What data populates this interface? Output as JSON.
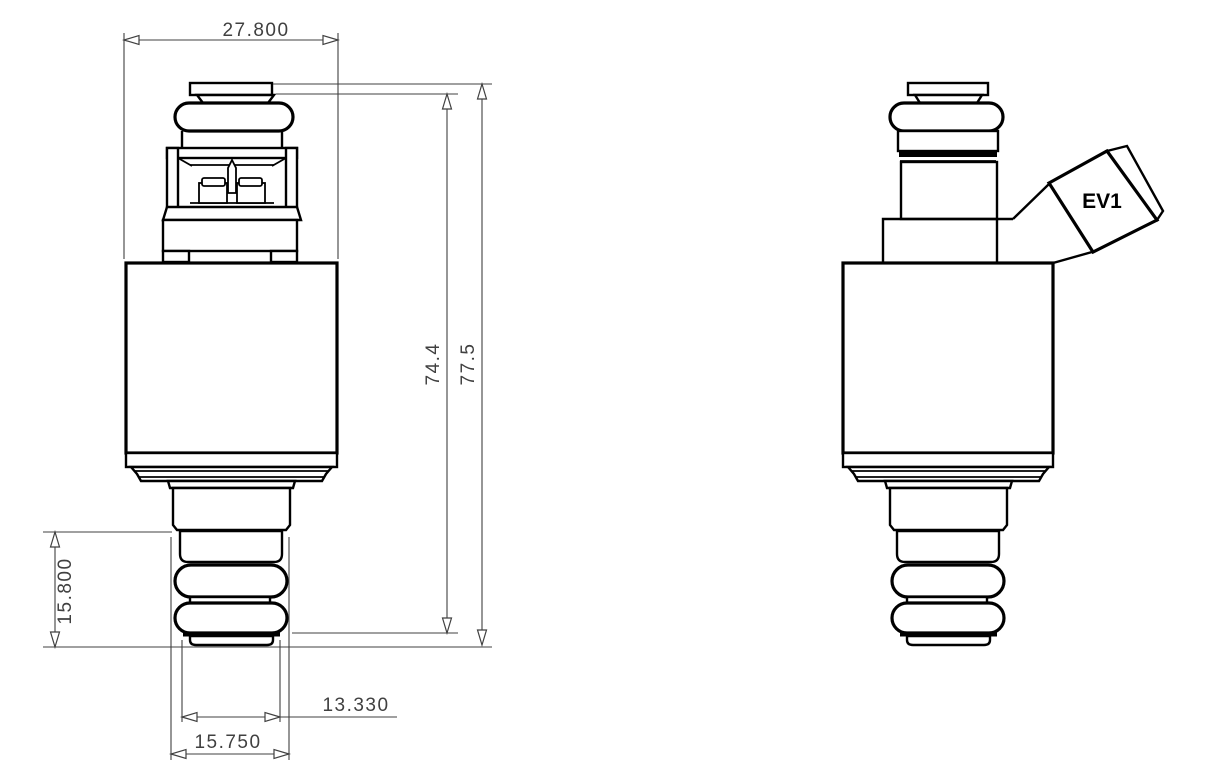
{
  "colors": {
    "background": "#ffffff",
    "part_outline": "#000000",
    "dimension_lines": "#404040",
    "dimension_text": "#404040",
    "connector_label_text": "#000000"
  },
  "front_view": {
    "dimensions": {
      "body_width": "27.800",
      "inner_height": "74.4",
      "overall_height": "77.5",
      "lower_stack_height": "15.800",
      "tip_cap_width": "13.330",
      "oring_width": "15.750"
    }
  },
  "side_view": {
    "connector_label": "EV1"
  }
}
